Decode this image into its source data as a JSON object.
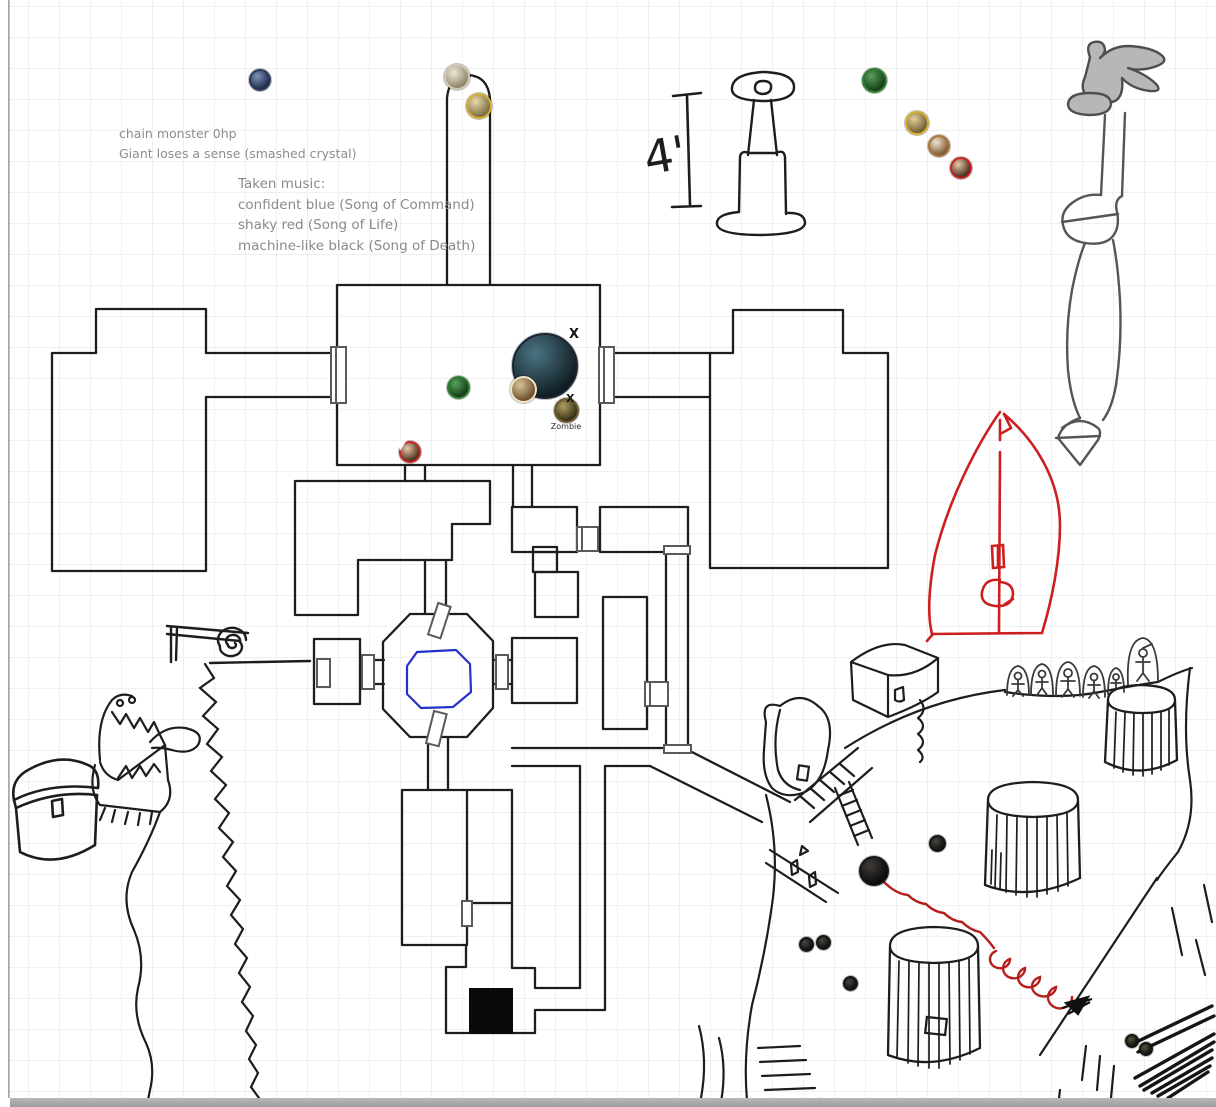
{
  "notes": {
    "combat_line1": "chain monster 0hp",
    "combat_line2": "Giant loses a sense (smashed crystal)",
    "music_title": "Taken music:",
    "music_items": [
      "confident blue (Song of Command)",
      "shaky red (Song of Life)",
      "machine-like black (Song of Death)"
    ]
  },
  "sketch": {
    "measurement_label": "4'",
    "zombie_label": "Zombie"
  },
  "marks": [
    {
      "text": "X",
      "x": 569,
      "y": 328,
      "s": 13
    },
    {
      "text": "X",
      "x": 566,
      "y": 393,
      "s": 11
    }
  ],
  "colors": {
    "ink": "#1d1d1d",
    "door_gray": "#5a5a5a",
    "note_text": "#8d8d8d",
    "red_ink": "#cc1f1f",
    "blue_ink": "#2233cc",
    "sword_fill": "#b7b7b7",
    "grid": "#f0f0f3"
  },
  "tokens": [
    {
      "name": "token-portrait-blue",
      "x": 260,
      "y": 80,
      "d": 22,
      "ring": "#2e3a5c",
      "c1": "#7c93b8",
      "c2": "#1d2a4a"
    },
    {
      "name": "token-portrait-pale",
      "x": 457,
      "y": 77,
      "d": 26,
      "ring": "#cfc7b2",
      "c1": "#efe8d8",
      "c2": "#8d8268"
    },
    {
      "name": "token-portrait-gold",
      "x": 479,
      "y": 106,
      "d": 26,
      "ring": "#d4af2f",
      "c1": "#e8d9a8",
      "c2": "#7a6a3f"
    },
    {
      "name": "token-portrait-green",
      "x": 874,
      "y": 80,
      "d": 25,
      "ring": "#2e7d32",
      "c1": "#57a05c",
      "c2": "#123a16"
    },
    {
      "name": "token-portrait-yellow",
      "x": 917,
      "y": 123,
      "d": 24,
      "ring": "#d4af2f",
      "c1": "#e3cf96",
      "c2": "#6d5c32"
    },
    {
      "name": "token-portrait-tan",
      "x": 939,
      "y": 146,
      "d": 22,
      "ring": "#a8743c",
      "c1": "#f0e3cf",
      "c2": "#7d5a33"
    },
    {
      "name": "token-portrait-red",
      "x": 961,
      "y": 168,
      "d": 22,
      "ring": "#cc2222",
      "c1": "#e8c9a8",
      "c2": "#4a2b1c"
    },
    {
      "name": "token-monster-large",
      "x": 545,
      "y": 366,
      "d": 66,
      "ring": "#1b2430",
      "c1": "#4a7483",
      "c2": "#101c22"
    },
    {
      "name": "token-portrait-green-2",
      "x": 458,
      "y": 387,
      "d": 23,
      "ring": "#2e7d32",
      "c1": "#57a05c",
      "c2": "#123a16"
    },
    {
      "name": "token-portrait-cream",
      "x": 523,
      "y": 389,
      "d": 27,
      "ring": "#efe3c8",
      "c1": "#d9c49a",
      "c2": "#6b4a2a"
    },
    {
      "name": "token-zombie",
      "x": 566,
      "y": 410,
      "d": 25,
      "ring": "#6b5a2a",
      "c1": "#b0a060",
      "c2": "#2f2a12",
      "label": "Zombie"
    },
    {
      "name": "token-portrait-red-2",
      "x": 410,
      "y": 452,
      "d": 22,
      "ring": "#cc2222",
      "c1": "#e8c9a8",
      "c2": "#4a2b1c",
      "notch": true
    },
    {
      "name": "token-dark-large",
      "x": 874,
      "y": 871,
      "d": 30,
      "ring": "#151515",
      "c1": "#3f3b38",
      "c2": "#0a0a0a"
    },
    {
      "name": "token-dark-small-1",
      "x": 937,
      "y": 843,
      "d": 17,
      "ring": "#151515",
      "c1": "#4a463c",
      "c2": "#101010"
    },
    {
      "name": "token-dark-small-2",
      "x": 806,
      "y": 944,
      "d": 15,
      "ring": "#151515",
      "c1": "#4a463c",
      "c2": "#101010"
    },
    {
      "name": "token-dark-small-3",
      "x": 823,
      "y": 942,
      "d": 15,
      "ring": "#151515",
      "c1": "#4a463c",
      "c2": "#101010"
    },
    {
      "name": "token-dark-small-4",
      "x": 850,
      "y": 983,
      "d": 15,
      "ring": "#151515",
      "c1": "#4a463c",
      "c2": "#101010"
    },
    {
      "name": "token-dark-small-5",
      "x": 1132,
      "y": 1041,
      "d": 14,
      "ring": "#151515",
      "c1": "#57533f",
      "c2": "#121210"
    },
    {
      "name": "token-dark-small-6",
      "x": 1146,
      "y": 1049,
      "d": 14,
      "ring": "#151515",
      "c1": "#57533f",
      "c2": "#121210"
    }
  ]
}
